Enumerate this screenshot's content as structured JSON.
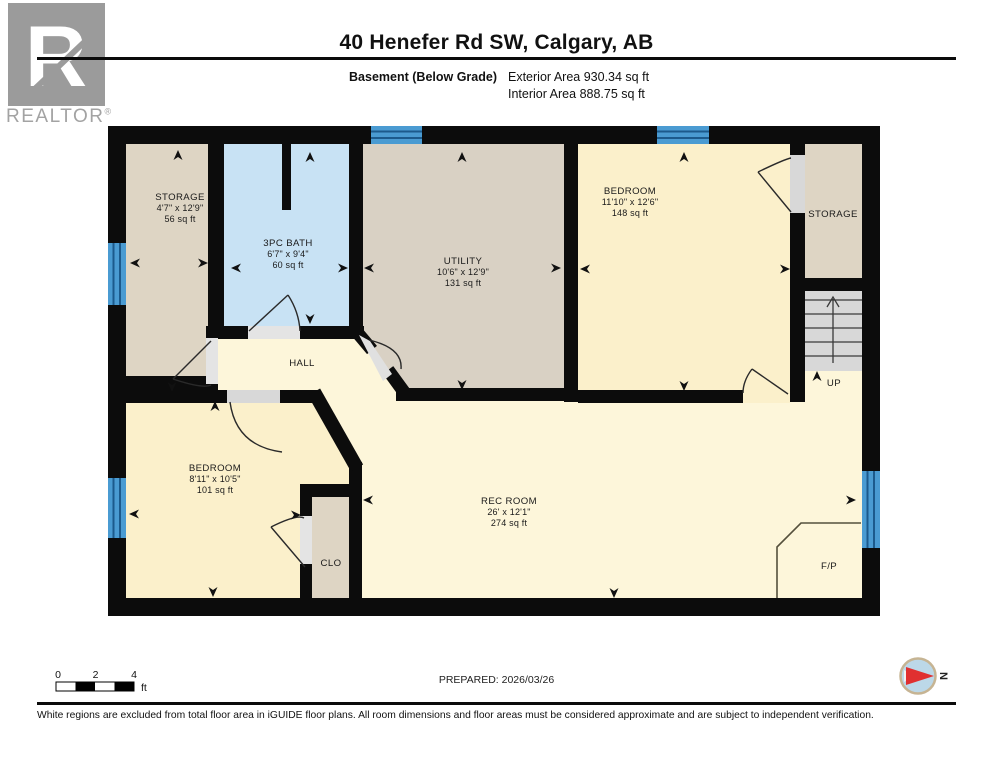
{
  "header": {
    "logo_r": "R",
    "logo_word": "REALTOR",
    "logo_reg": "®",
    "title": "40 Henefer Rd SW, Calgary, AB",
    "floor_label": "Basement (Below Grade)",
    "exterior_area": "Exterior Area 930.34 sq ft",
    "interior_area": "Interior Area 888.75 sq ft"
  },
  "rooms": {
    "storage_tl": {
      "name": "STORAGE",
      "dims": "4'7\" x 12'9\"",
      "area": "56 sq ft"
    },
    "bath": {
      "name": "3PC BATH",
      "dims": "6'7\" x 9'4\"",
      "area": "60 sq ft"
    },
    "utility": {
      "name": "UTILITY",
      "dims": "10'6\" x 12'9\"",
      "area": "131 sq ft"
    },
    "bedroom_tr": {
      "name": "BEDROOM",
      "dims": "11'10\" x 12'6\"",
      "area": "148 sq ft"
    },
    "storage_r": {
      "name": "STORAGE"
    },
    "hall": {
      "name": "HALL"
    },
    "bedroom_bl": {
      "name": "BEDROOM",
      "dims": "8'11\" x 10'5\"",
      "area": "101 sq ft"
    },
    "clo": {
      "name": "CLO"
    },
    "rec_room": {
      "name": "REC ROOM",
      "dims": "26' x 12'1\"",
      "area": "274 sq ft"
    },
    "fireplace": {
      "name": "F/P"
    },
    "stairs": {
      "name": "UP"
    }
  },
  "scale_bar": {
    "tick0": "0",
    "tick1": "2",
    "tick2": "4",
    "unit": "ft"
  },
  "prepared": "PREPARED: 2026/03/26",
  "compass": {
    "north_label": "N"
  },
  "footer": {
    "disclaimer": "White regions are excluded from total floor area in iGUIDE floor plans. All room dimensions and floor areas must be considered approximate and are subject to independent verification."
  },
  "colors": {
    "wall": "#0c0c0c",
    "window_blue": "#4a9bd2",
    "bath_fill": "#c8e2f4",
    "tan_fill": "#ded5c4",
    "utility_fill": "#d9d1c4",
    "cream_fill": "#fdf6da",
    "bedroom_fill": "#fbf0cb",
    "stair_fill": "#d8d8d8",
    "compass_red": "#e03030"
  }
}
